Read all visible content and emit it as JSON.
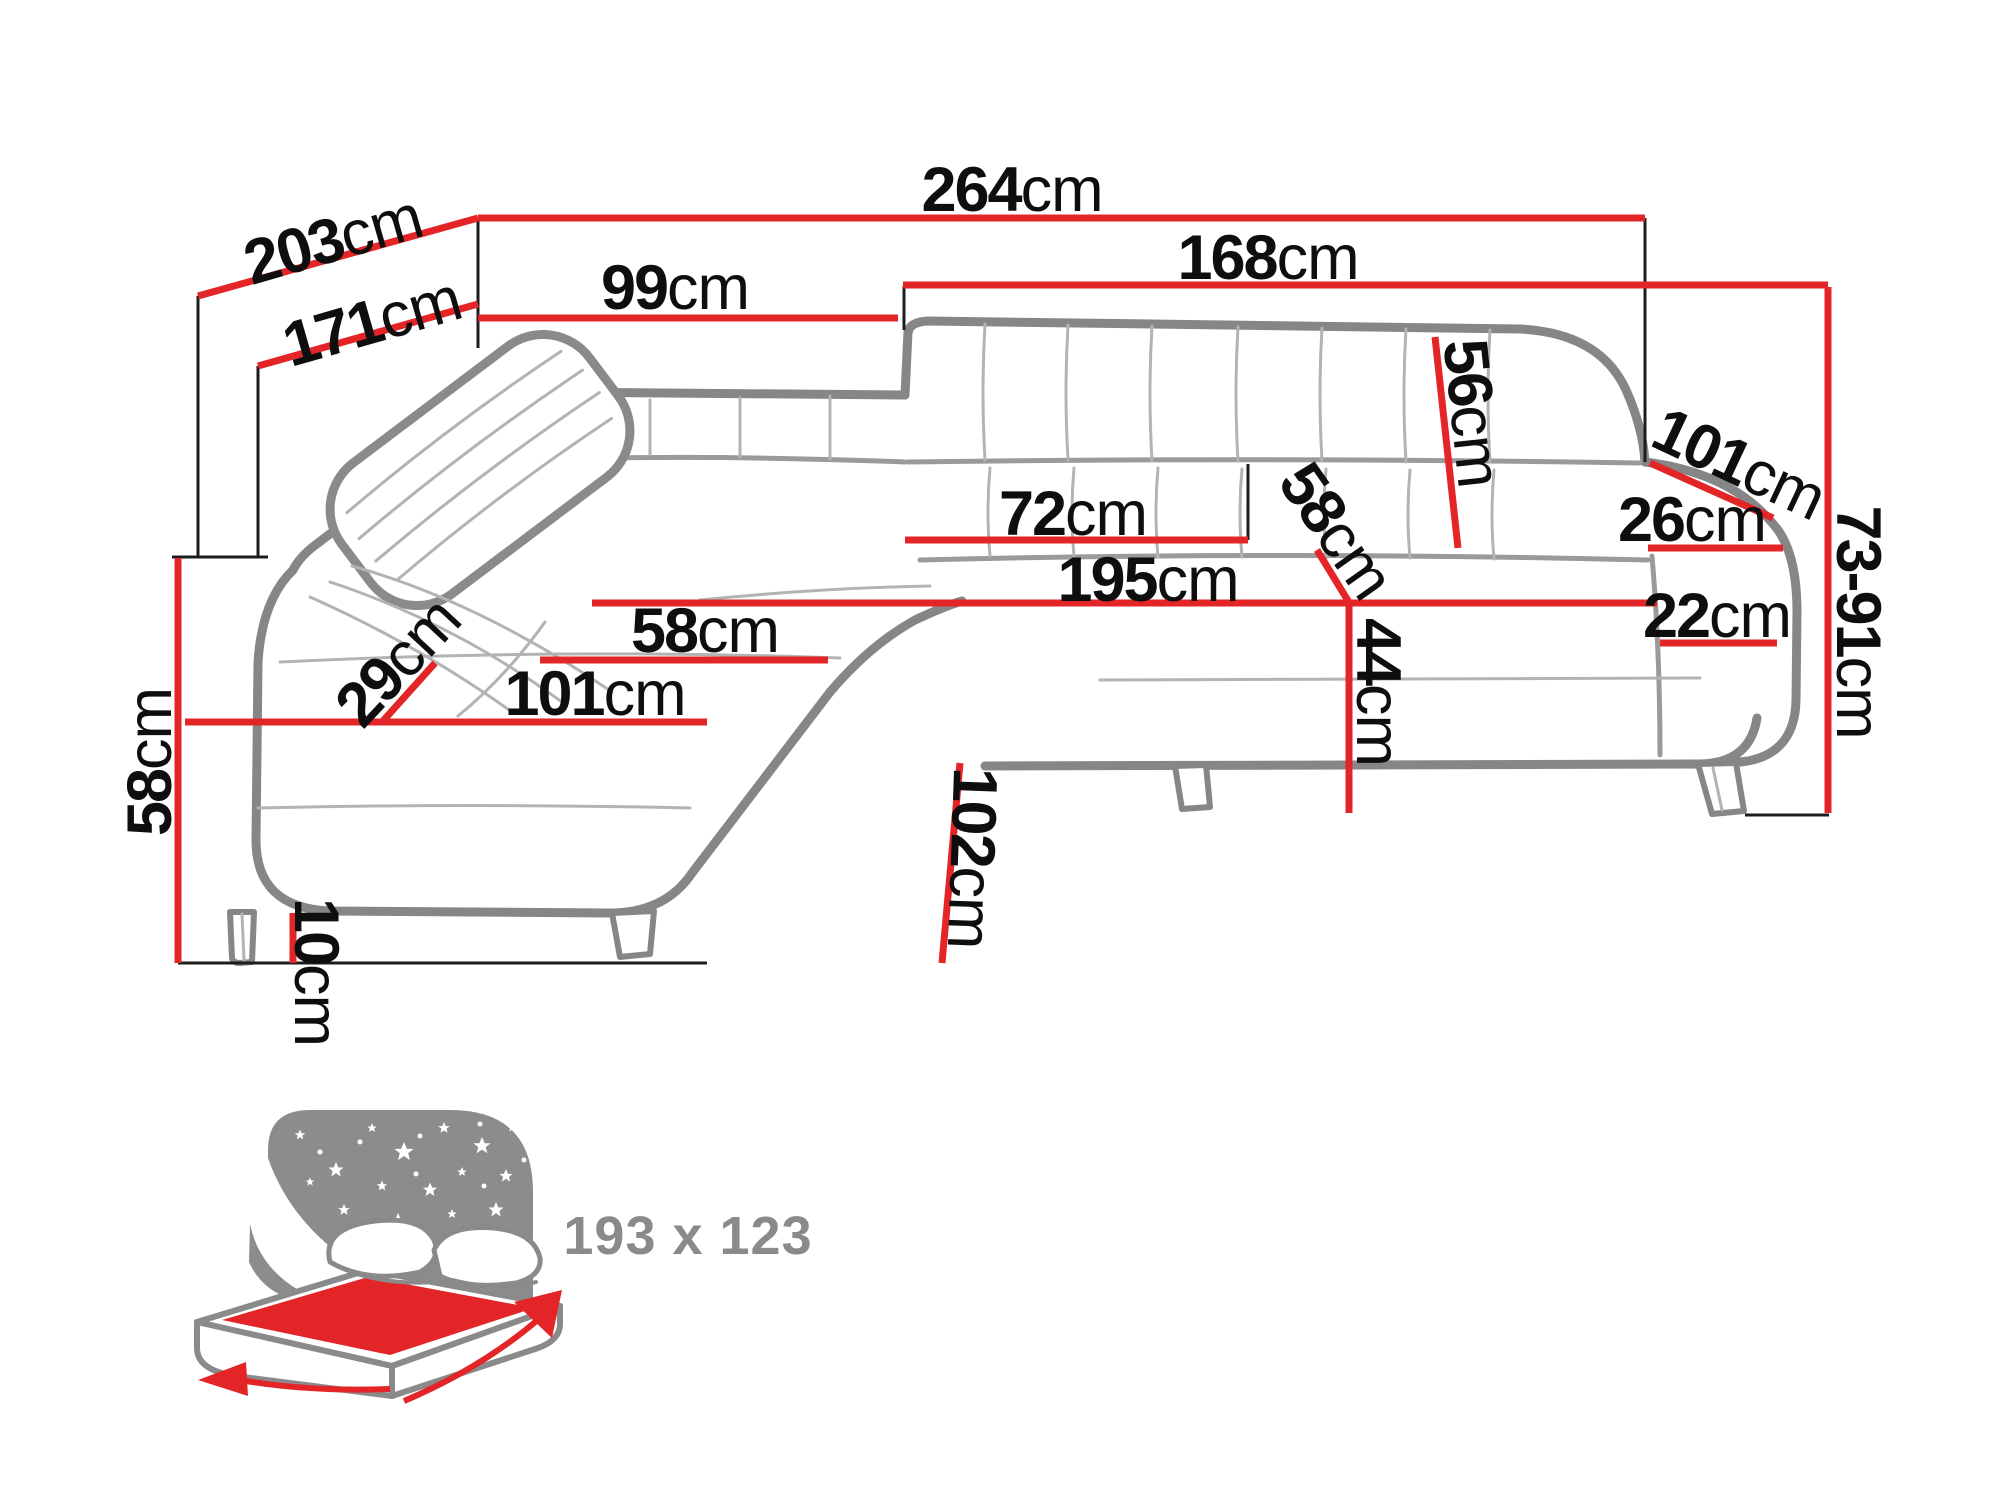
{
  "diagram": {
    "description": "Corner sofa-bed technical dimension drawing",
    "unit_default": "cm",
    "colors": {
      "dimension_red": "#e42528",
      "outline_gray": "#868686",
      "detail_gray": "#b3b3b3",
      "icon_gray": "#8c8c8c",
      "label_black": "#0e0e0e",
      "background": "#ffffff"
    }
  },
  "dims": [
    {
      "id": "back-width-left-diagonal",
      "value": "203",
      "unit": "cm"
    },
    {
      "id": "inner-depth-left-diagonal",
      "value": "171",
      "unit": "cm"
    },
    {
      "id": "total-width",
      "value": "264",
      "unit": "cm"
    },
    {
      "id": "right-section-width",
      "value": "168",
      "unit": "cm"
    },
    {
      "id": "left-section-width",
      "value": "99",
      "unit": "cm"
    },
    {
      "id": "backrest-height",
      "value": "56",
      "unit": "cm"
    },
    {
      "id": "armrest-depth",
      "value": "101",
      "unit": "cm"
    },
    {
      "id": "armrest-top-width",
      "value": "26",
      "unit": "cm"
    },
    {
      "id": "overall-height-range",
      "value": "73-91",
      "unit": "cm"
    },
    {
      "id": "seat-depth",
      "value": "72",
      "unit": "cm"
    },
    {
      "id": "seat-width-diagonal",
      "value": "58",
      "unit": "cm"
    },
    {
      "id": "seat-front-length",
      "value": "195",
      "unit": "cm"
    },
    {
      "id": "armrest-base-width",
      "value": "22",
      "unit": "cm"
    },
    {
      "id": "chaise-cushion-diagonal",
      "value": "29",
      "unit": "cm"
    },
    {
      "id": "chaise-seat-width",
      "value": "58",
      "unit": "cm"
    },
    {
      "id": "chaise-front-length",
      "value": "101",
      "unit": "cm"
    },
    {
      "id": "seat-height",
      "value": "44",
      "unit": "cm"
    },
    {
      "id": "side-height",
      "value": "58",
      "unit": "cm"
    },
    {
      "id": "chaise-depth",
      "value": "102",
      "unit": "cm"
    },
    {
      "id": "leg-clearance",
      "value": "10",
      "unit": "cm"
    }
  ],
  "bed": {
    "icon": "sleeping-function-icon",
    "size_label": "193 x 123"
  }
}
